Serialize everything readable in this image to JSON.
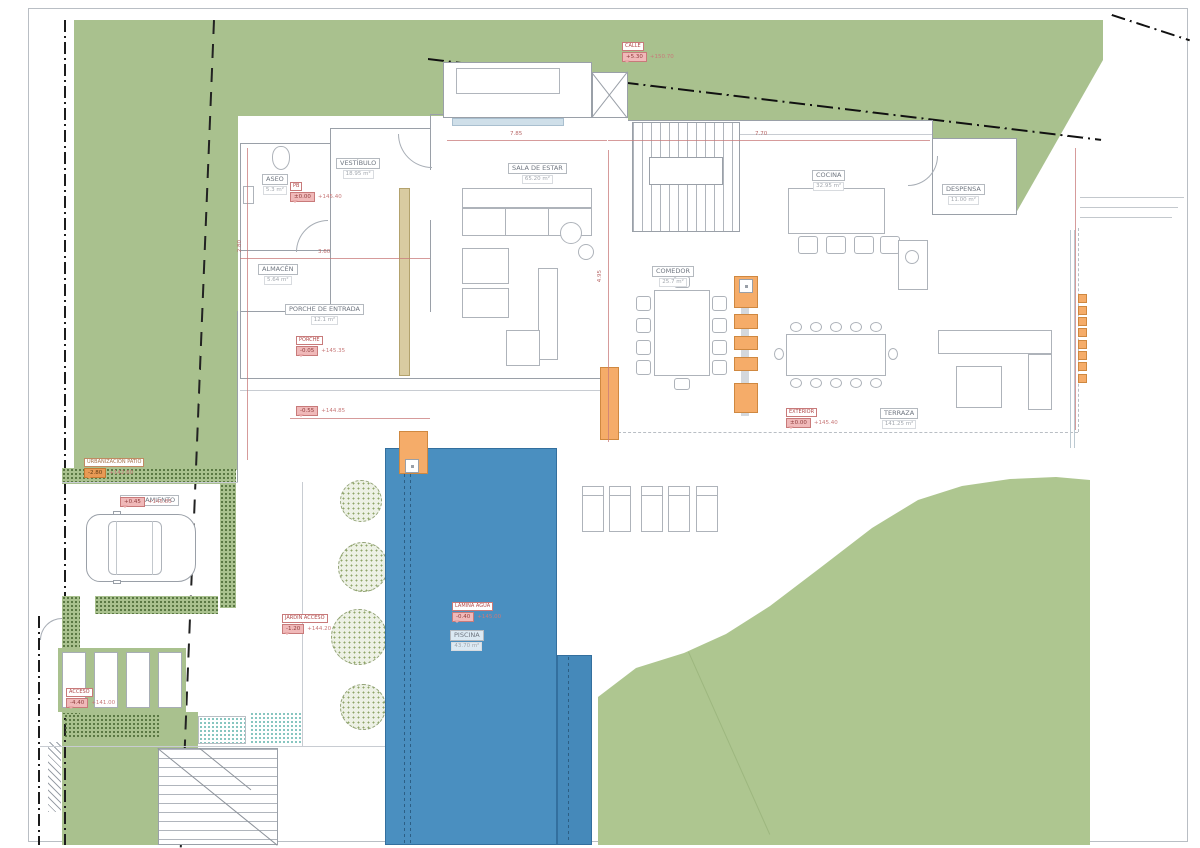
{
  "rooms": {
    "aseo": {
      "name": "ASEO",
      "area": "5.3 m²"
    },
    "vestibulo": {
      "name": "VESTÍBULO",
      "area": "18.95 m²"
    },
    "almacen": {
      "name": "ALMACÉN",
      "area": "5.64 m²"
    },
    "porche": {
      "name": "PORCHE DE ENTRADA",
      "area": "12.1 m²"
    },
    "sala": {
      "name": "SALA DE ESTAR",
      "area": "65.20 m²"
    },
    "cocina": {
      "name": "COCINA",
      "area": "32.95 m²"
    },
    "despensa": {
      "name": "DESPENSA",
      "area": "11.00 m²"
    },
    "comedor": {
      "name": "COMEDOR",
      "area": "25.7 m²"
    },
    "terraza": {
      "name": "TERRAZA",
      "area": "141.25 m²"
    },
    "piscina": {
      "name": "PISCINA",
      "area": "43.70 m²"
    },
    "aparcamiento": {
      "name": "APARCAMIENTO"
    }
  },
  "levels": {
    "calle": {
      "title": "CALLE",
      "rel": "+5.30",
      "abs": "+150.70"
    },
    "patio": {
      "title": "URBANIZACIÓN PATIO",
      "rel": "-2.80",
      "abs": "+142.60"
    },
    "pb": {
      "title": "PB",
      "rel": "±0.00",
      "abs": "+145.40"
    },
    "porche": {
      "title": "PORCHE",
      "rel": "-0.05",
      "abs": "+145.35"
    },
    "acera": {
      "rel": "-0.55",
      "abs": "+144.85"
    },
    "terraza": {
      "title": "EXTERIOR",
      "rel": "±0.00",
      "abs": "+145.40"
    },
    "piscina": {
      "title": "LÁMINA AGUA",
      "rel": "-0.40",
      "abs": "+145.00"
    },
    "jardin": {
      "title": "JARDÍN ACCESO",
      "rel": "-1.20",
      "abs": "+144.20"
    },
    "aparcamiento": {
      "rel": "+0.45",
      "abs": "+145.85"
    },
    "acceso": {
      "title": "ACCESO",
      "rel": "-4.40",
      "abs": "+141.00"
    }
  },
  "dims": {
    "d1": "7.85",
    "d2": "7.70",
    "d3": "4.95",
    "d4": "2.80",
    "d5": "3.60"
  },
  "colors": {
    "garden_green": "#a9c18e",
    "pool_blue": "#4a8fc0",
    "accent_orange": "#f5ac69",
    "dimension_red": "#c87a7a",
    "boundary_black": "#1a1a1a",
    "planting_teal": "#5fb3ab"
  }
}
